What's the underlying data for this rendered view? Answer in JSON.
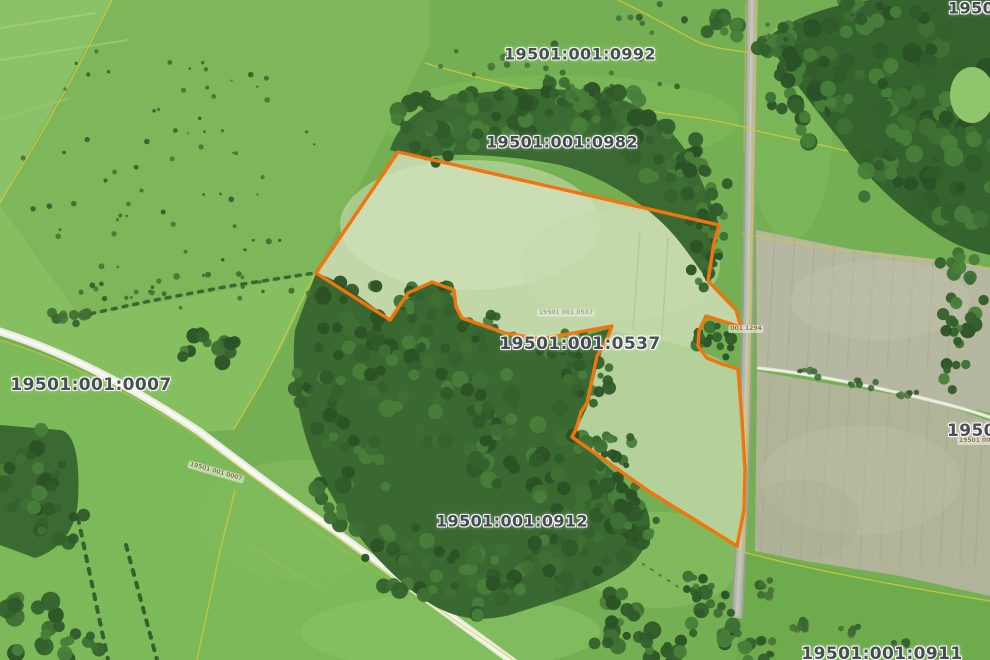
{
  "map": {
    "type": "cadastral-aerial-map",
    "highlighted_parcel": "19501:001:0537",
    "colors": {
      "parcel_outline": "#f0750f",
      "cadastral_line": "#d4c938",
      "label_text": "#454a54",
      "label_halo": "#ffffff"
    },
    "labels": [
      {
        "id": "0992",
        "text": "19501:001:0992",
        "x": 580,
        "y": 54,
        "size": 16
      },
      {
        "id": "0982",
        "text": "19501:001:0982",
        "x": 562,
        "y": 142,
        "size": 16
      },
      {
        "id": "0537",
        "text": "19501:001:0537",
        "x": 580,
        "y": 344,
        "size": 17
      },
      {
        "id": "0007",
        "text": "19501:001:0007",
        "x": 91,
        "y": 385,
        "size": 17
      },
      {
        "id": "0912",
        "text": "19501:001:0912",
        "x": 512,
        "y": 521,
        "size": 16
      },
      {
        "id": "0911",
        "text": "19501:001:0911",
        "x": 882,
        "y": 654,
        "size": 17
      },
      {
        "id": "right-edge",
        "text": "19501:00",
        "x": 947,
        "y": 431,
        "size": 17,
        "anchor": "left"
      },
      {
        "id": "top-right",
        "text": "19501:0",
        "x": 948,
        "y": 8,
        "size": 16,
        "anchor": "left"
      }
    ],
    "tiny_labels": [
      {
        "id": "road-0007",
        "text": "19501 001 0007",
        "x": 216,
        "y": 472,
        "rot": 16,
        "faint": false
      },
      {
        "id": "parcel-0537-small",
        "text": "19501 001 0537",
        "x": 566,
        "y": 313,
        "rot": 0,
        "faint": true
      },
      {
        "id": "road-1294",
        "text": "001 1294",
        "x": 746,
        "y": 329,
        "rot": 0,
        "faint": false
      },
      {
        "id": "right-edge-small",
        "text": "19501 001 09",
        "x": 957,
        "y": 441,
        "rot": 0,
        "faint": false,
        "anchor": "left"
      }
    ]
  }
}
